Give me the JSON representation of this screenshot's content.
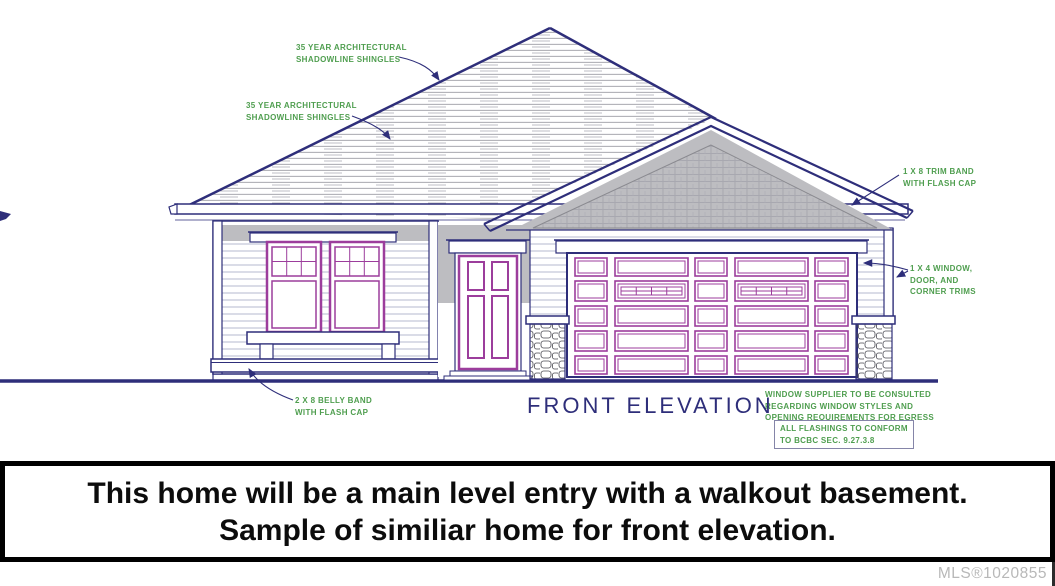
{
  "drawing": {
    "title": "FRONT ELEVATION",
    "annotations": {
      "shingles_note_1": "35 YEAR ARCHITECTURAL\nSHADOWLINE SHINGLES",
      "shingles_note_2": "35 YEAR ARCHITECTURAL\nSHADOWLINE SHINGLES",
      "trim_band_note": "1 X 8 TRIM BAND\nWITH FLASH CAP",
      "window_trims_note": "1 X 4  WINDOW,\nDOOR, AND\nCORNER TRIMS",
      "belly_band_note": "2 X 8 BELLY BAND\nWITH FLASH CAP",
      "window_supplier_note": "WINDOW SUPPLIER TO BE CONSULTED\nREGARDING WINDOW STYLES AND\nOPENING REQUIREMENTS FOR EGRESS",
      "flashing_note": "ALL FLASHINGS TO CONFORM\nTO BCBC SEC. 9.27.3.8"
    },
    "colors": {
      "line_navy": "#2e2e7a",
      "annotation_green": "#4f9e4f",
      "trim_magenta": "#9c3d9c",
      "shade_gray": "#bdbdc1",
      "banner_border_black": "#000000"
    }
  },
  "banner": {
    "line1": "This home will be a main level entry with a walkout basement.",
    "line2": "Sample of similiar home for front elevation."
  },
  "footer": {
    "mls_label": "MLS®1020855"
  }
}
